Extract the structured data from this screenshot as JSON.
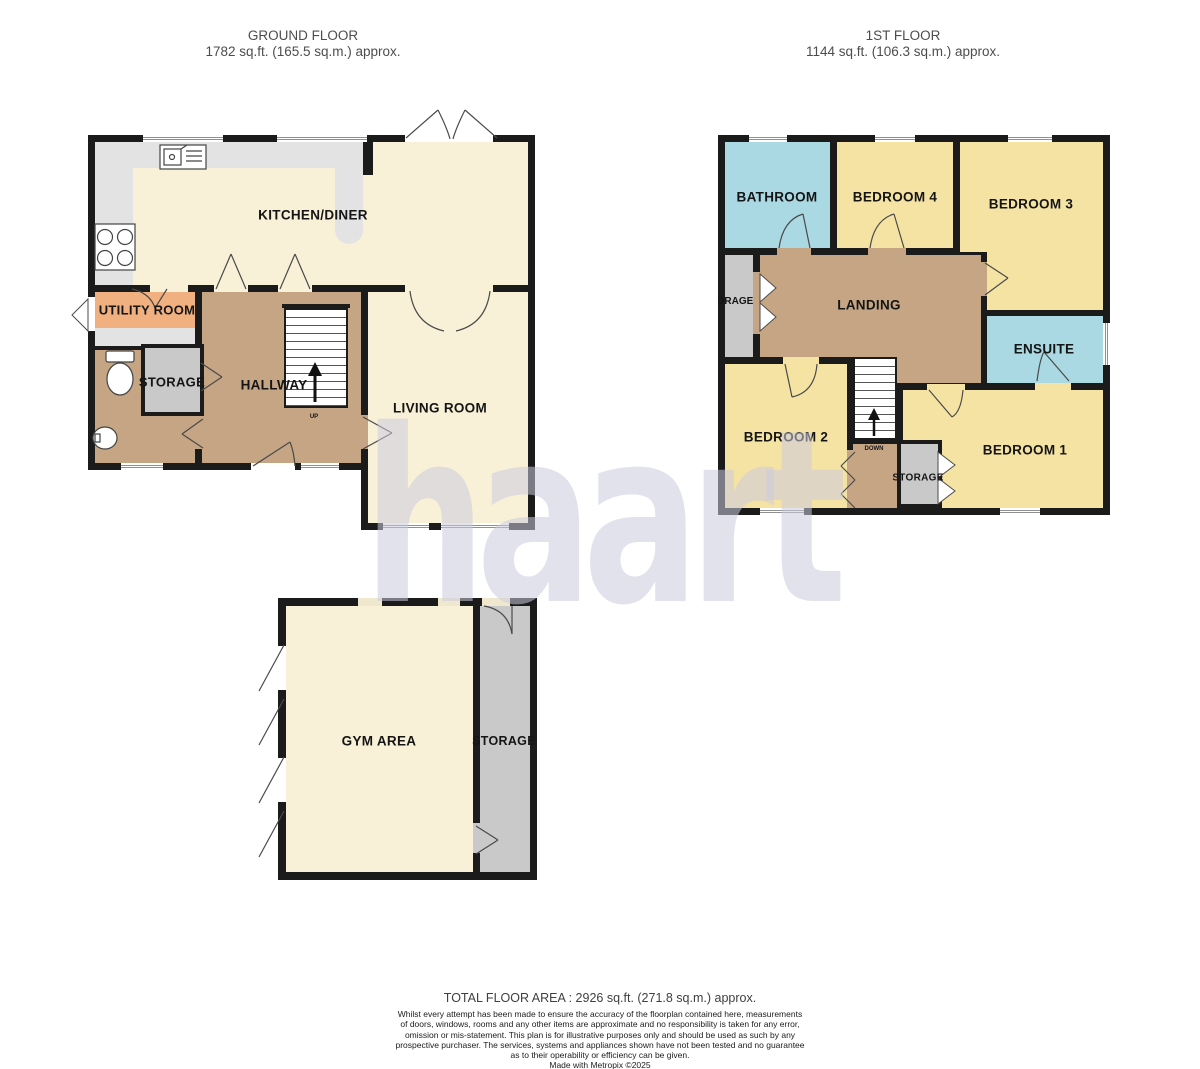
{
  "floorplan": {
    "ground_floor": {
      "title": "GROUND FLOOR",
      "area": "1782 sq.ft. (165.5 sq.m.) approx.",
      "rooms": {
        "kitchen_diner": "KITCHEN/DINER",
        "utility_room": "UTILITY ROOM",
        "storage": "STORAGE",
        "hallway": "HALLWAY",
        "living_room": "LIVING ROOM",
        "gym_area": "GYM AREA",
        "gym_storage": "STORAGE"
      },
      "stairs_direction": "UP"
    },
    "first_floor": {
      "title": "1ST FLOOR",
      "area": "1144 sq.ft. (106.3 sq.m.) approx.",
      "rooms": {
        "bathroom": "BATHROOM",
        "bedroom_4": "BEDROOM 4",
        "bedroom_3": "BEDROOM 3",
        "storage": "STORAGE",
        "landing": "LANDING",
        "ensuite": "ENSUITE",
        "bedroom_2": "BEDROOM 2",
        "bedroom_1": "BEDROOM 1",
        "storage_small": "STORAGE"
      },
      "stairs_direction": "DOWN"
    }
  },
  "watermark": "haart",
  "footer": {
    "total_area": "TOTAL FLOOR AREA : 2926 sq.ft. (271.8 sq.m.) approx.",
    "disclaimer": "Whilst every attempt has been made to ensure the accuracy of the floorplan contained here, measurements\nof doors, windows, rooms and any other items are approximate and no responsibility is taken for any error,\nomission or mis-statement. This plan is for illustrative purposes only and should be used as such by any\nprospective purchaser. The services, systems and appliances shown have not been tested and no guarantee\nas to their operability or efficiency can be given.",
    "credit": "Made with Metropix ©2025"
  },
  "colors": {
    "wall": "#1b1b1b",
    "floor_cream": "#F8F1D7",
    "floor_yellow": "#F5E3A4",
    "floor_blue": "#AAD8E3",
    "floor_tan": "#C5A584",
    "floor_peach": "#F0B07F",
    "floor_gray": "#C9C9C9",
    "worktop_gray": "#E3E3E3",
    "watermark": "#DBDBE7"
  }
}
